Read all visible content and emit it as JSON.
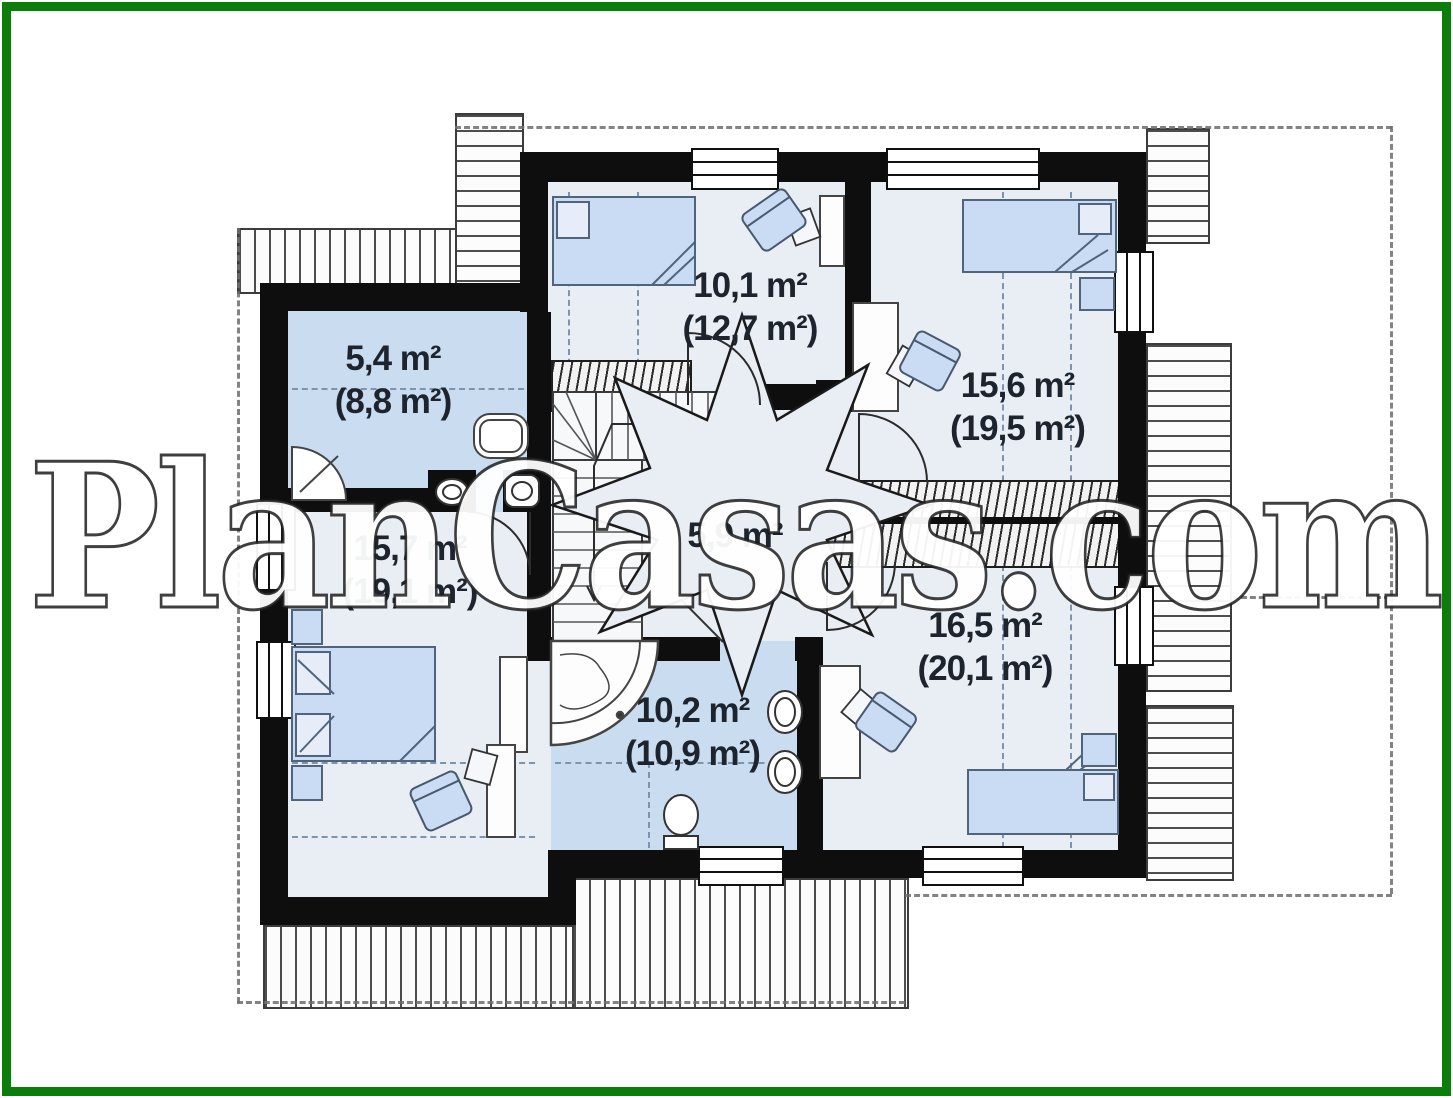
{
  "watermark": {
    "text": "PlanCasas.com"
  },
  "plan": {
    "title": "attic floor plan",
    "rooms": [
      {
        "id": "bathroom-top-left",
        "area": "5,4 m²",
        "area_gross": "(8,8 m²)"
      },
      {
        "id": "bedroom-top-center",
        "area": "10,1 m²",
        "area_gross": "(12,7 m²)"
      },
      {
        "id": "bedroom-top-right",
        "area": "15,6 m²",
        "area_gross": "(19,5 m²)"
      },
      {
        "id": "bedroom-left",
        "area": "15,7 m²",
        "area_gross": "(19,1 m²)"
      },
      {
        "id": "hall",
        "area": "5,9 m²",
        "area_gross": ""
      },
      {
        "id": "bathroom-bottom",
        "area": "10,2 m²",
        "area_gross": "(10,9 m²)"
      },
      {
        "id": "bedroom-bottom-right",
        "area": "16,5 m²",
        "area_gross": "(20,1 m²)"
      }
    ],
    "colors": {
      "frame_green": "#0b7d0b",
      "wall_black": "#0e0e0e",
      "floor_light": "#e9edf4",
      "floor_bathroom": "#c9dcf0",
      "furniture_blue": "#c9dcf3",
      "label_text": "#1d242e",
      "hatch_gray": "#4d4d4d"
    }
  }
}
